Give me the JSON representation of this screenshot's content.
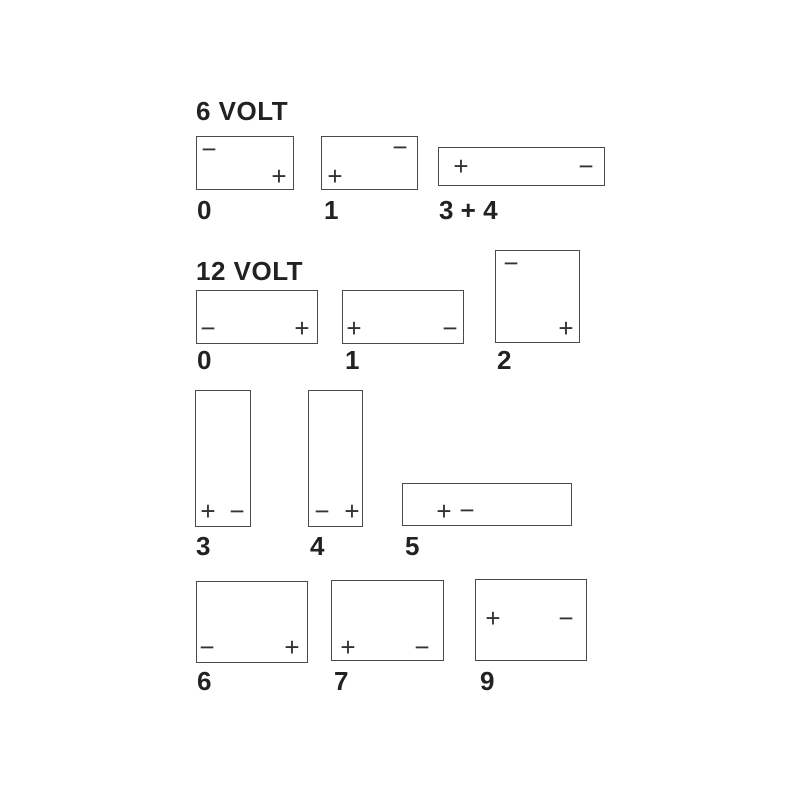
{
  "page": {
    "background_color": "#ffffff",
    "line_color": "#4a4a4a",
    "text_color": "#222222",
    "terminal_color": "#333333"
  },
  "sections": [
    {
      "heading": "6 VOLT",
      "heading_pos": {
        "x": 196,
        "y": 98
      },
      "batteries": [
        {
          "label": "0",
          "layout_code": "0",
          "box": {
            "x": 196,
            "y": 136,
            "w": 98,
            "h": 54
          },
          "label_pos": {
            "x": 197,
            "y": 197
          },
          "terminals": [
            {
              "sign": "minus",
              "glyph": "−",
              "position": "top-left",
              "x": 209,
              "y": 149
            },
            {
              "sign": "plus",
              "glyph": "+",
              "position": "bottom-right",
              "x": 279,
              "y": 176
            }
          ]
        },
        {
          "label": "1",
          "layout_code": "1",
          "box": {
            "x": 321,
            "y": 136,
            "w": 97,
            "h": 54
          },
          "label_pos": {
            "x": 324,
            "y": 197
          },
          "terminals": [
            {
              "sign": "plus",
              "glyph": "+",
              "position": "bottom-left",
              "x": 335,
              "y": 176
            },
            {
              "sign": "minus",
              "glyph": "−",
              "position": "top-right",
              "x": 400,
              "y": 147
            }
          ]
        },
        {
          "label": "3 + 4",
          "layout_code": "3 + 4",
          "box": {
            "x": 438,
            "y": 147,
            "w": 167,
            "h": 39
          },
          "label_pos": {
            "x": 439,
            "y": 197
          },
          "terminals": [
            {
              "sign": "plus",
              "glyph": "+",
              "position": "middle-left",
              "x": 461,
              "y": 166
            },
            {
              "sign": "minus",
              "glyph": "−",
              "position": "middle-right",
              "x": 586,
              "y": 166
            }
          ]
        }
      ]
    },
    {
      "heading": "12 VOLT",
      "heading_pos": {
        "x": 196,
        "y": 258
      },
      "batteries": [
        {
          "label": "0",
          "layout_code": "0",
          "box": {
            "x": 196,
            "y": 290,
            "w": 122,
            "h": 54
          },
          "label_pos": {
            "x": 197,
            "y": 347
          },
          "terminals": [
            {
              "sign": "minus",
              "glyph": "−",
              "position": "bottom-left",
              "x": 208,
              "y": 328
            },
            {
              "sign": "plus",
              "glyph": "+",
              "position": "bottom-right",
              "x": 302,
              "y": 328
            }
          ]
        },
        {
          "label": "1",
          "layout_code": "1",
          "box": {
            "x": 342,
            "y": 290,
            "w": 122,
            "h": 54
          },
          "label_pos": {
            "x": 345,
            "y": 347
          },
          "terminals": [
            {
              "sign": "plus",
              "glyph": "+",
              "position": "bottom-left",
              "x": 354,
              "y": 328
            },
            {
              "sign": "minus",
              "glyph": "−",
              "position": "bottom-right",
              "x": 450,
              "y": 328
            }
          ]
        },
        {
          "label": "2",
          "layout_code": "2",
          "box": {
            "x": 495,
            "y": 250,
            "w": 85,
            "h": 93
          },
          "label_pos": {
            "x": 497,
            "y": 347
          },
          "terminals": [
            {
              "sign": "minus",
              "glyph": "−",
              "position": "top-left",
              "x": 511,
              "y": 263
            },
            {
              "sign": "plus",
              "glyph": "+",
              "position": "bottom-right",
              "x": 566,
              "y": 328
            }
          ]
        },
        {
          "label": "3",
          "layout_code": "3",
          "box": {
            "x": 195,
            "y": 390,
            "w": 56,
            "h": 137
          },
          "label_pos": {
            "x": 196,
            "y": 533
          },
          "terminals": [
            {
              "sign": "plus",
              "glyph": "+",
              "position": "bottom-left",
              "x": 208,
              "y": 511
            },
            {
              "sign": "minus",
              "glyph": "−",
              "position": "bottom-right",
              "x": 237,
              "y": 511
            }
          ]
        },
        {
          "label": "4",
          "layout_code": "4",
          "box": {
            "x": 308,
            "y": 390,
            "w": 55,
            "h": 137
          },
          "label_pos": {
            "x": 310,
            "y": 533
          },
          "terminals": [
            {
              "sign": "minus",
              "glyph": "−",
              "position": "bottom-left",
              "x": 322,
              "y": 511
            },
            {
              "sign": "plus",
              "glyph": "+",
              "position": "bottom-right",
              "x": 352,
              "y": 511
            }
          ]
        },
        {
          "label": "5",
          "layout_code": "5",
          "box": {
            "x": 402,
            "y": 483,
            "w": 170,
            "h": 43
          },
          "label_pos": {
            "x": 405,
            "y": 533
          },
          "terminals": [
            {
              "sign": "plus",
              "glyph": "+",
              "position": "center-left",
              "x": 444,
              "y": 511
            },
            {
              "sign": "minus",
              "glyph": "−",
              "position": "center-left",
              "x": 467,
              "y": 510
            }
          ]
        },
        {
          "label": "6",
          "layout_code": "6",
          "box": {
            "x": 196,
            "y": 581,
            "w": 112,
            "h": 82
          },
          "label_pos": {
            "x": 197,
            "y": 668
          },
          "terminals": [
            {
              "sign": "minus",
              "glyph": "−",
              "position": "bottom-left",
              "x": 207,
              "y": 647
            },
            {
              "sign": "plus",
              "glyph": "+",
              "position": "bottom-right",
              "x": 292,
              "y": 647
            }
          ]
        },
        {
          "label": "7",
          "layout_code": "7",
          "box": {
            "x": 331,
            "y": 580,
            "w": 113,
            "h": 81
          },
          "label_pos": {
            "x": 334,
            "y": 668
          },
          "terminals": [
            {
              "sign": "plus",
              "glyph": "+",
              "position": "bottom-left",
              "x": 348,
              "y": 647
            },
            {
              "sign": "minus",
              "glyph": "−",
              "position": "bottom-right",
              "x": 422,
              "y": 647
            }
          ]
        },
        {
          "label": "9",
          "layout_code": "9",
          "box": {
            "x": 475,
            "y": 579,
            "w": 112,
            "h": 82
          },
          "label_pos": {
            "x": 480,
            "y": 668
          },
          "terminals": [
            {
              "sign": "plus",
              "glyph": "+",
              "position": "upper-left",
              "x": 493,
              "y": 618
            },
            {
              "sign": "minus",
              "glyph": "−",
              "position": "upper-right",
              "x": 566,
              "y": 618
            }
          ]
        }
      ]
    }
  ]
}
